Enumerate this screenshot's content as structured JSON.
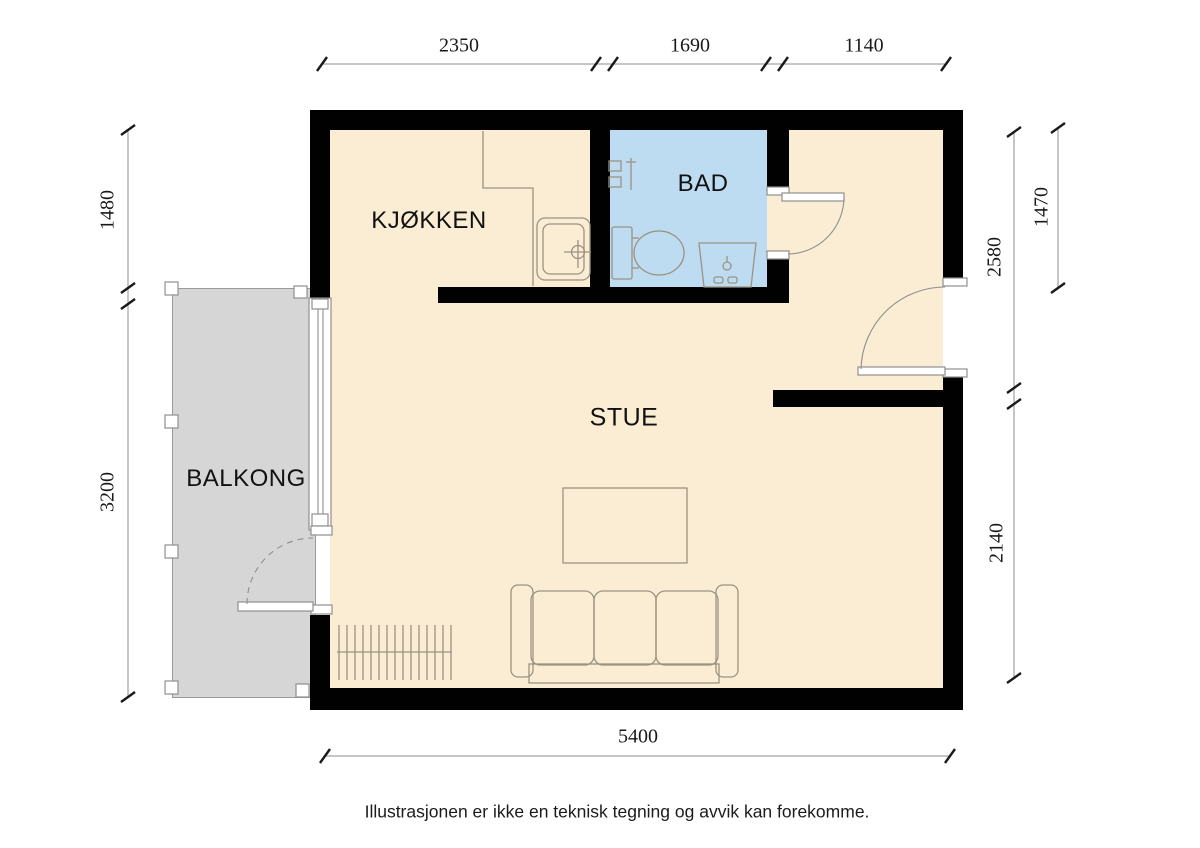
{
  "rooms": {
    "kitchen": "KJØKKEN",
    "bath": "BAD",
    "living": "STUE",
    "balcony": "BALKONG"
  },
  "dimensions": {
    "top": [
      "2350",
      "1690",
      "1140"
    ],
    "left": [
      "1480",
      "3200"
    ],
    "right_inner": [
      "2580",
      "2140"
    ],
    "right_outer": [
      "1470"
    ],
    "bottom": [
      "5400"
    ]
  },
  "disclaimer": "Illustrasjonen er ikke en teknisk tegning og avvik kan forekomme.",
  "icons": {
    "kitchen_sink": "kitchen-sink-icon",
    "toilet": "toilet-icon",
    "bath_sink": "bathroom-sink-icon",
    "shower_mixer": "shower-mixer-icon",
    "sofa": "sofa-icon",
    "coffee_table": "coffee-table-icon",
    "radiator": "radiator-icon"
  },
  "colors": {
    "floor": "#FAEDD3",
    "bath": "#BEDCF1",
    "balcony": "#D6D6D6",
    "wall": "#010101",
    "line": "#9B9382",
    "frame": "#8F8F8F",
    "dim_line": "#8C8C8C",
    "dim": "#1A1A1A",
    "text": "#111111"
  }
}
